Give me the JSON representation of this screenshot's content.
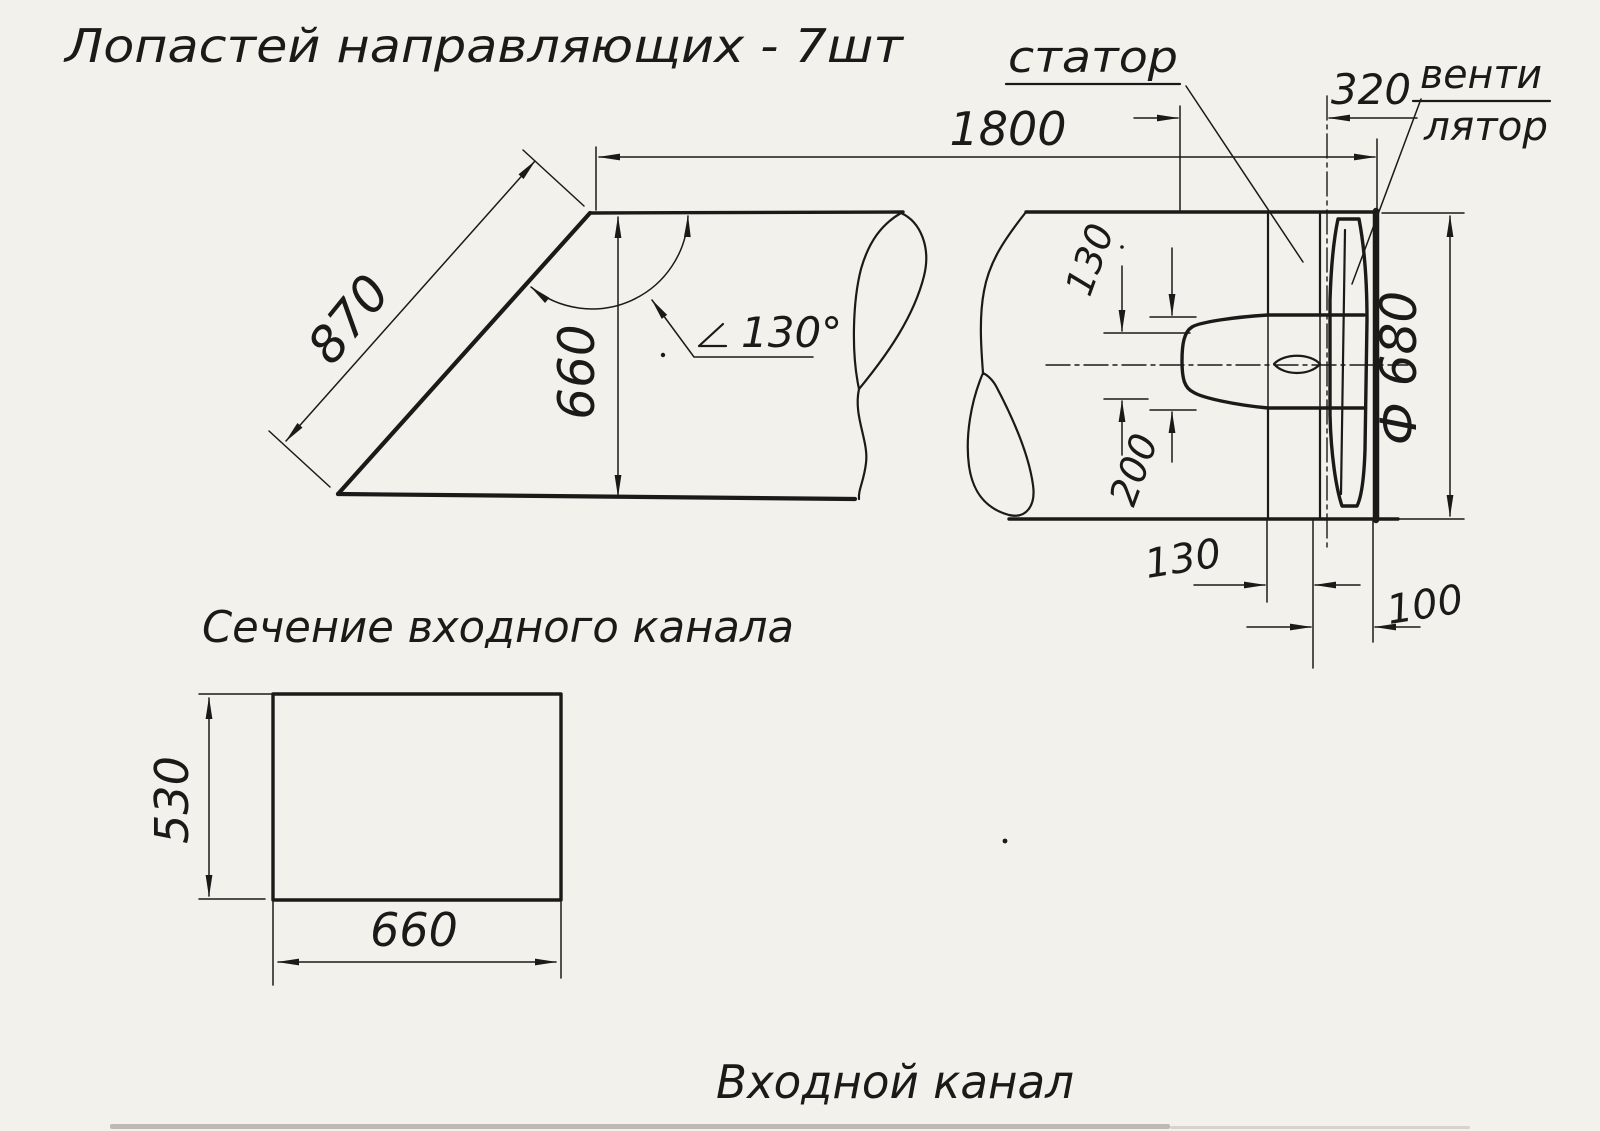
{
  "drawing": {
    "note_top": "Лопастей направляющих - 7шт",
    "labels": {
      "stator": "статор",
      "fan_line1": "венти",
      "fan_line2": "лятор"
    },
    "captions": {
      "section": "Сечение входного канала",
      "bottom": "Входной канал"
    },
    "dims": {
      "total_length": "1800",
      "fan_plane_offset": "320",
      "slant_length": "870",
      "inlet_height": "660",
      "angle": "130°",
      "hub_nose": "130",
      "hub_length": "200",
      "fan_diameter": "Ф 680",
      "strut_to_fan": "130",
      "fan_to_wall": "100",
      "section_height": "530",
      "section_width": "660"
    },
    "colors": {
      "ink": "#1c1a18",
      "paper": "#f3f1ec"
    }
  }
}
